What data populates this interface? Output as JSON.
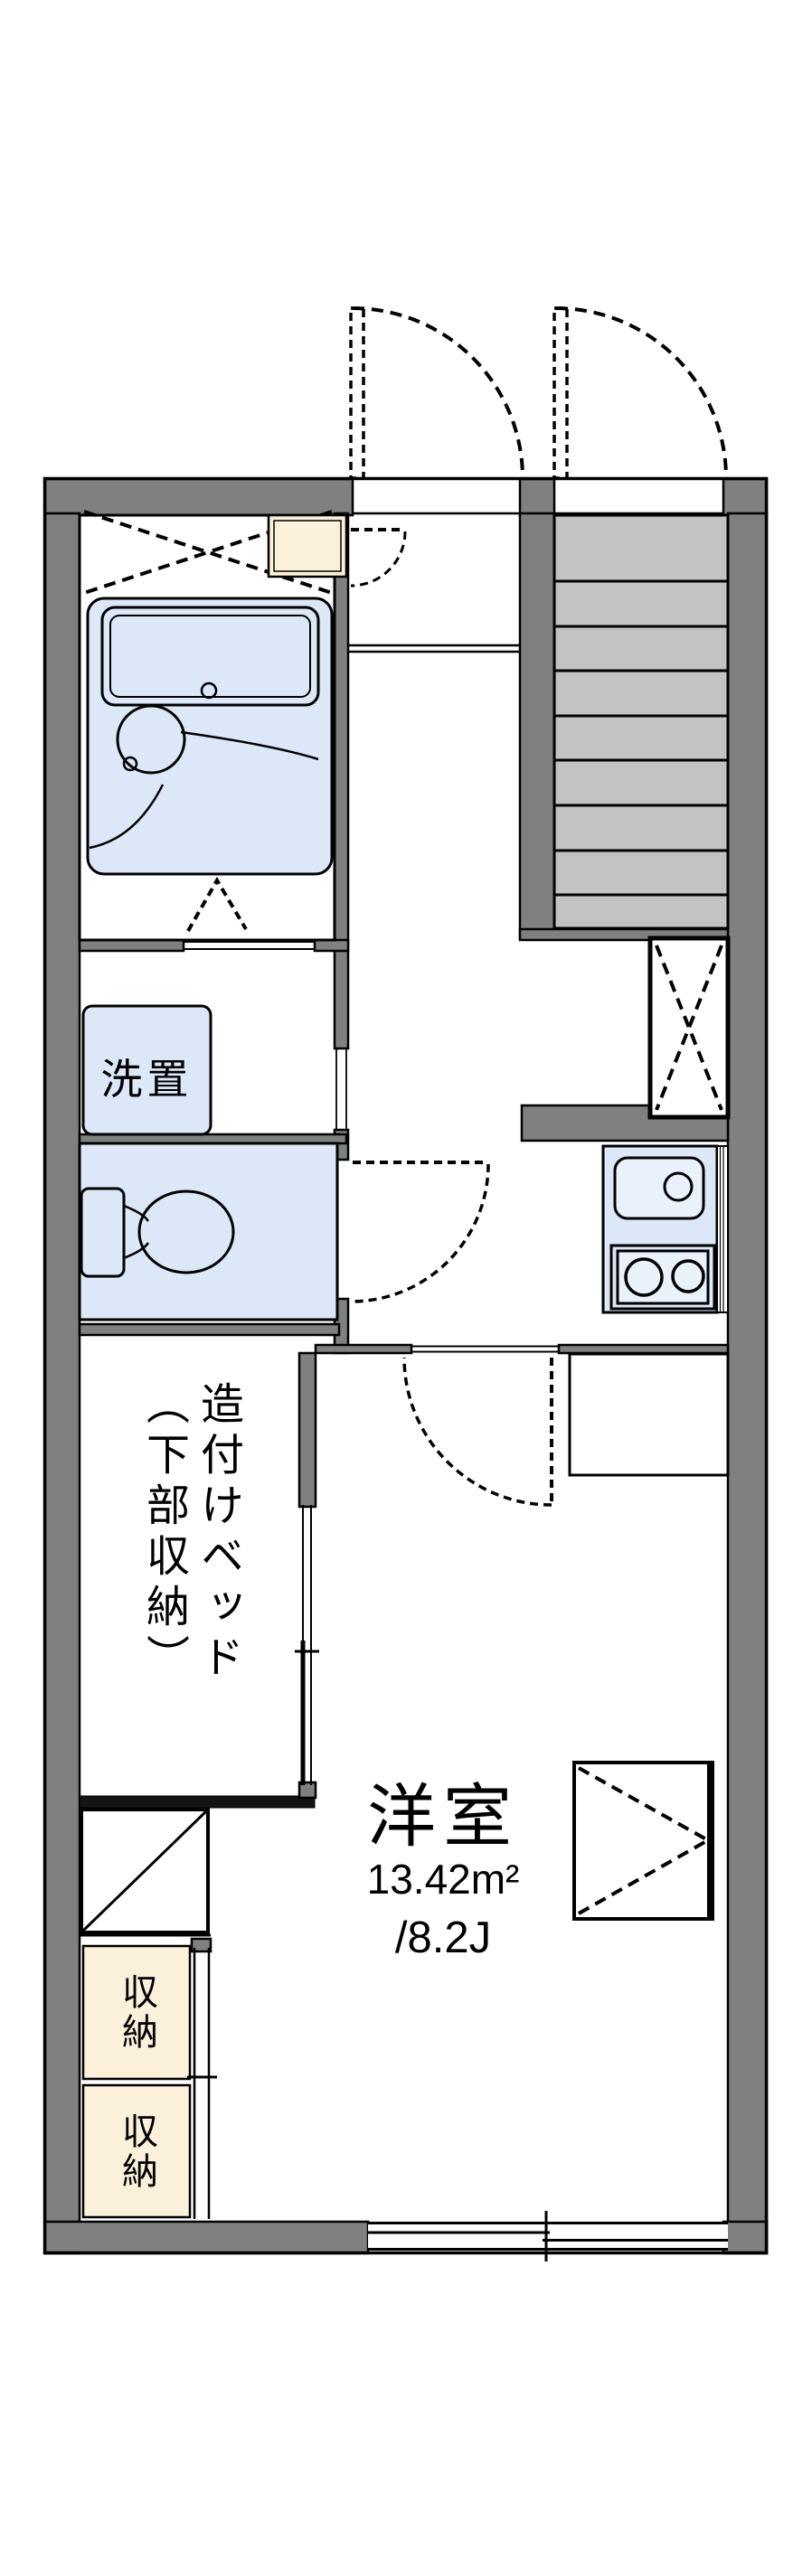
{
  "plan": {
    "type": "apartment-floor-plan",
    "rooms": {
      "main": {
        "name": "洋室",
        "area_sqm": "13.42m²",
        "area_tatami": "/8.2J"
      },
      "bed_label": "造付けベッド\n（下部収納）",
      "washer_label": "洗置",
      "storage_upper_label": "収納",
      "storage_lower_label": "収納"
    },
    "colors": {
      "wall": "#7f8080",
      "stair_tread": "#c3c3c3",
      "fixture_blue": "#dce8f7",
      "fixture_light": "#e9f1fb",
      "storage_cream": "#fbf0da",
      "line": "#000000",
      "background": "#ffffff"
    }
  }
}
